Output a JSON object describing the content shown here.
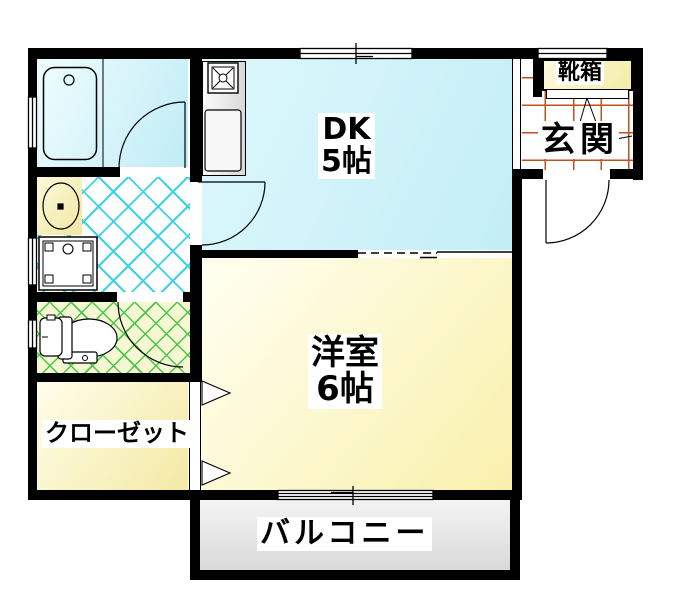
{
  "floor_plan": {
    "title": "1DK apartment floor plan",
    "rooms": {
      "dk": {
        "label": "DK",
        "size": "5帖"
      },
      "western": {
        "label": "洋室",
        "size": "6帖"
      },
      "balcony": {
        "label": "バルコニー"
      },
      "closet": {
        "label": "クローゼット"
      },
      "entrance": {
        "label": "玄関"
      },
      "shoe_box": {
        "label": "靴箱"
      }
    },
    "fixtures": [
      "bathtub-icon",
      "washbasin-icon",
      "washing-machine-icon",
      "toilet-icon",
      "stove-icon",
      "kitchen-sink-icon"
    ],
    "colors": {
      "wall": "#000000",
      "dk_fill": "#c8eff7",
      "western_fill": "#f9f0ac",
      "closet_fill": "#f3e9a4",
      "shoe_box_fill": "#f6f0b4",
      "balcony_fill": "#e4e4e4",
      "washroom_lattice": "#3ed2e4",
      "toilet_lattice": "#46c846",
      "entrance_grid": "#bf5222"
    }
  }
}
